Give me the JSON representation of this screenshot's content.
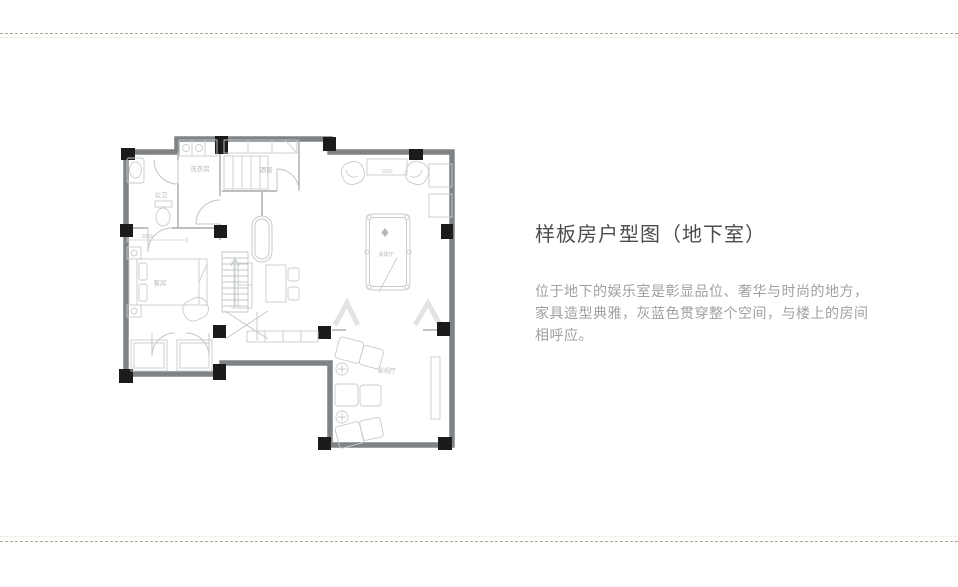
{
  "page": {
    "background": "#ffffff",
    "divider_dash_color": "#a9a98f",
    "divider_dot_color": "#e2e2d0"
  },
  "panel": {
    "title": "样板房户型图（地下室）",
    "lines": [
      "位于地下的娱乐室是彰显品位、奢华与时尚的地方，",
      "家具造型典雅，灰蓝色贯穿整个空间，与楼上的房间",
      "相呼应。"
    ],
    "title_color": "#4d4d4d",
    "text_color": "#a0a0a0"
  },
  "floorplan": {
    "colors": {
      "wall": "#7f8385",
      "column": "#1b1b1b",
      "interior_wall": "#a6abae",
      "furniture": "#c7ccce",
      "label": "#b3b7ba"
    },
    "labels": {
      "laundry": "洗衣房",
      "bathroom": "公卫",
      "wine_cellar": "酒窖",
      "guest_room": "客房",
      "billiard_room": "桌球厅",
      "home_theater": "影视厅"
    },
    "dimensions": {
      "bar_table_width": "1500",
      "guest_room_width": "2050"
    }
  }
}
